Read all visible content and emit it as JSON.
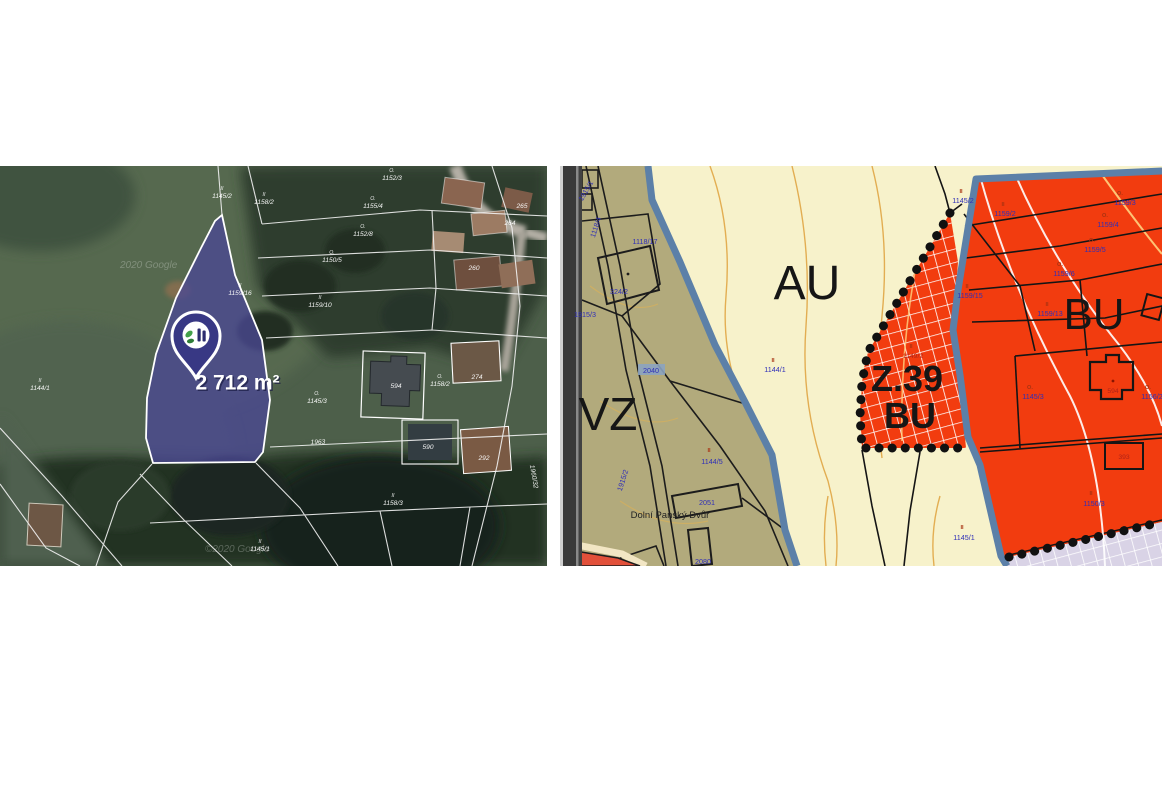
{
  "left_map": {
    "area_label": "2 712 m²",
    "watermark_top": "2020 Google",
    "watermark_bottom": "©2020 Google",
    "colors": {
      "parcel_fill": "#4a4894",
      "pin_fill": "#383884"
    },
    "labels": [
      {
        "text": "1145/2",
        "marker": "II"
      },
      {
        "text": "1158/2",
        "marker": "II"
      },
      {
        "text": "1152/3",
        "marker": "O."
      },
      {
        "text": "1155/4",
        "marker": "O."
      },
      {
        "text": "1152/8",
        "marker": "O."
      },
      {
        "text": "1150/5",
        "marker": "O."
      },
      {
        "text": "1159/16",
        "marker": "II"
      },
      {
        "text": "1159/10",
        "marker": "II"
      },
      {
        "text": "1144/1",
        "marker": "II"
      },
      {
        "text": "1145/3",
        "marker": "O."
      },
      {
        "text": "594",
        "marker": ""
      },
      {
        "text": "1158/2",
        "marker": "O."
      },
      {
        "text": "274",
        "marker": ""
      },
      {
        "text": "590",
        "marker": ""
      },
      {
        "text": "292",
        "marker": ""
      },
      {
        "text": "1158/3",
        "marker": "II"
      },
      {
        "text": "1145/1",
        "marker": "II"
      },
      {
        "text": "265",
        "marker": ""
      },
      {
        "text": "264",
        "marker": ""
      },
      {
        "text": "260",
        "marker": ""
      },
      {
        "text": "1960/32",
        "marker": ""
      },
      {
        "text": "1963",
        "marker": ""
      }
    ]
  },
  "right_map": {
    "zones": [
      "AU",
      "BU",
      "Z.39",
      "BU",
      "VZ"
    ],
    "place_label": "Dolní Panský Dvůr",
    "highlighted_parcel": "2040",
    "colors": {
      "au_fill": "#f7f2cb",
      "vz_fill": "#b2aa7c",
      "bu_fill": "#f23c0f",
      "boundary_blue": "#5c80a8",
      "reserve_lavender": "#d9d3e6",
      "parcel_number_blue": "#2f2fb8",
      "marker_red": "#a83312",
      "contour_orange": "#dfa23d"
    },
    "labels": [
      {
        "text": "1118/17",
        "marker": ""
      },
      {
        "text": "324/2",
        "marker": ""
      },
      {
        "text": "1915/3",
        "marker": ""
      },
      {
        "text": "1118/4",
        "marker": ""
      },
      {
        "text": "1915/1",
        "marker": ""
      },
      {
        "text": "2040",
        "marker": ""
      },
      {
        "text": "1144/1",
        "marker": "II"
      },
      {
        "text": "1144/5",
        "marker": "II"
      },
      {
        "text": "2051",
        "marker": ""
      },
      {
        "text": "1915/2",
        "marker": ""
      },
      {
        "text": "2080",
        "marker": ""
      },
      {
        "text": "1145/2",
        "marker": "II"
      },
      {
        "text": "1159/2",
        "marker": "II"
      },
      {
        "text": "1159/3",
        "marker": "O."
      },
      {
        "text": "1159/4",
        "marker": "O."
      },
      {
        "text": "1159/5",
        "marker": "O."
      },
      {
        "text": "1159/6",
        "marker": "O."
      },
      {
        "text": "1159/15",
        "marker": "II"
      },
      {
        "text": "1159/13",
        "marker": "II"
      },
      {
        "text": "1149/2",
        "marker": "II"
      },
      {
        "text": "1145/3",
        "marker": "O."
      },
      {
        "text": "594",
        "marker": ""
      },
      {
        "text": "1156/2",
        "marker": "O."
      },
      {
        "text": "393",
        "marker": ""
      },
      {
        "text": "1150/3",
        "marker": "II"
      },
      {
        "text": "1145/1",
        "marker": "II"
      }
    ]
  }
}
